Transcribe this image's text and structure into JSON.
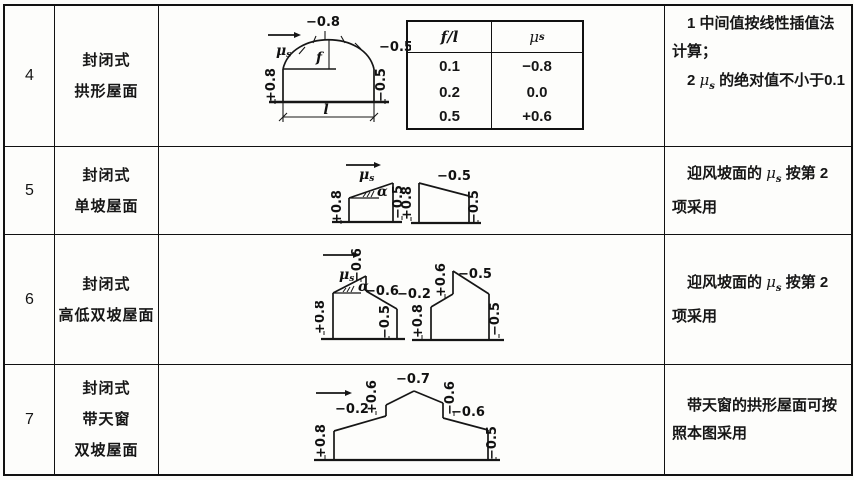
{
  "symbols": {
    "mu": "μ",
    "sub_s": "s",
    "alpha": "α",
    "f": "f",
    "l": "l",
    "f_over_l": "f/l"
  },
  "r4": {
    "no": "4",
    "name1": "封闭式",
    "name2": "拱形屋面",
    "d": {
      "top": "−0.8",
      "flank": "−0.5",
      "lw": "+0.8",
      "rw": "−0.5"
    },
    "ft": {
      "r1a": "0.1",
      "r1b": "−0.8",
      "r2a": "0.2",
      "r2b": "0.0",
      "r3a": "0.5",
      "r3b": "+0.6"
    },
    "note1": "1  中间值按线性插值法计算；",
    "note2a": "2  ",
    "note2b": " 的绝对值不小于0.1"
  },
  "r5": {
    "no": "5",
    "name1": "封闭式",
    "name2": "单坡屋面",
    "d": {
      "a_lw": "+0.8",
      "a_rw": "−0.5",
      "b_top": "−0.5",
      "b_lw": "+0.8",
      "b_rw": "−0.5"
    },
    "note_a": "迎风坡面的 ",
    "note_b": " 按第 2 项采用"
  },
  "r6": {
    "no": "6",
    "name1": "封闭式",
    "name2": "高低双坡屋面",
    "d": {
      "a_peak": "−0.6",
      "a_slope": "−0.6",
      "a_lw": "+0.8",
      "a_rw": "−0.5",
      "b_s1": "−0.2",
      "b_riser": "+0.6",
      "b_top": "−0.5",
      "b_lw": "+0.8",
      "b_rw": "−0.5"
    },
    "note_a": "迎风坡面的 ",
    "note_b": " 按第 2 项采用"
  },
  "r7": {
    "no": "7",
    "name1": "封闭式",
    "name2": "带天窗",
    "name3": "双坡屋面",
    "d": {
      "lw": "+0.8",
      "s1": "−0.2",
      "riser": "+0.6",
      "top": "−0.7",
      "drop": "−0.6",
      "s2": "−0.6",
      "rw": "−0.5"
    },
    "note": "带天窗的拱形屋面可按照本图采用"
  }
}
